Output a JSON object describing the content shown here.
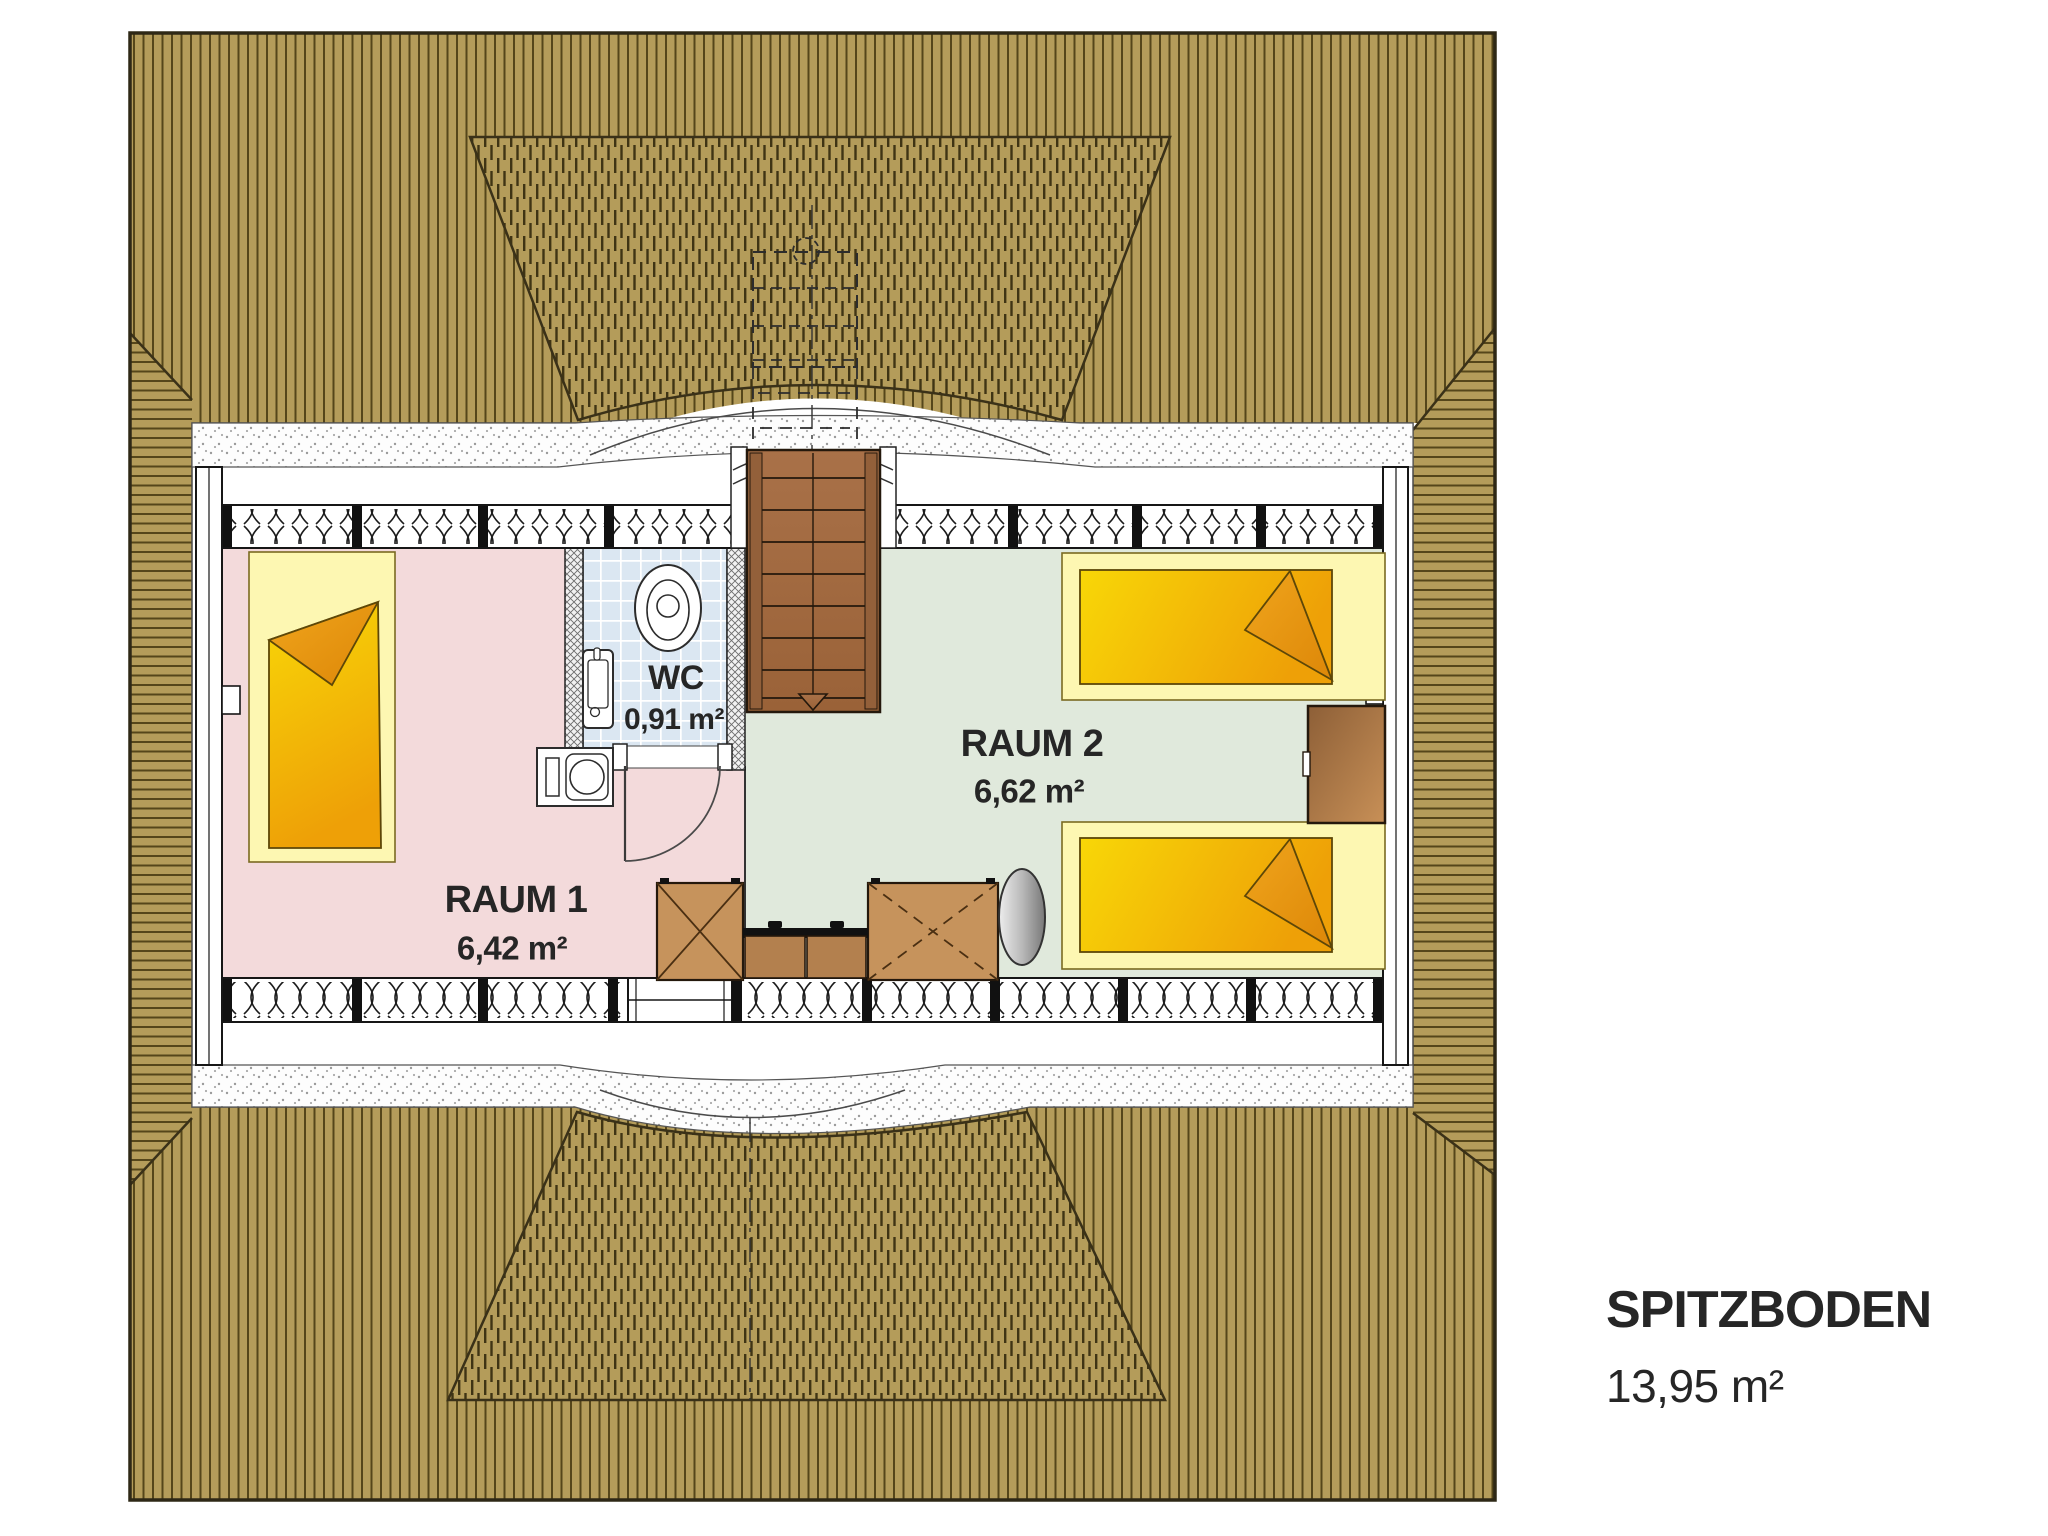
{
  "plan": {
    "title": "SPITZBODEN",
    "title_area": "13,95 m²",
    "rooms": [
      {
        "id": "raum1",
        "name": "RAUM 1",
        "area": "6,42 m²"
      },
      {
        "id": "wc",
        "name": "WC",
        "area": "0,91 m²"
      },
      {
        "id": "raum2",
        "name": "RAUM 2",
        "area": "6,62 m²"
      }
    ],
    "fixtures": [
      "staircase",
      "toilet-icon",
      "sink-icon",
      "washing-machine-icon",
      "bed",
      "wardrobe-box",
      "sideboard",
      "tv-dish",
      "door-swing",
      "window",
      "insulated-wall",
      "eyebrow-dormer",
      "hip-roof"
    ],
    "colors": {
      "roof_wood": "#b49c5a",
      "roof_line": "#55461a",
      "roof_edge": "#2e2816",
      "raum1_floor": "#f3dadb",
      "raum2_floor": "#e0e9dc",
      "wc_tile": "#dbe7f2",
      "bed_pale": "#fdf7b2",
      "bed_yellow": "#f8d707",
      "bed_orange": "#eea007",
      "furniture_wood": "#c6935c",
      "stair_wood": "#a97148",
      "text": "#262626"
    }
  }
}
